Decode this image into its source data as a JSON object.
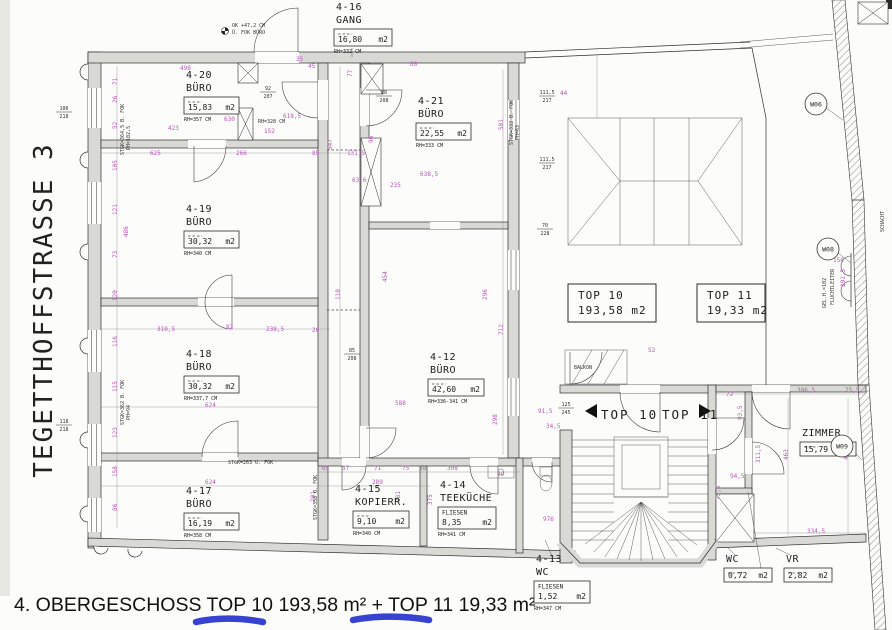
{
  "page": {
    "bottom_title": "4. OBERGESCHOSS TOP 10 193,58 m² + TOP 11 19,33 m²",
    "street_label": "TEGETTHOFFSTRASSE 3"
  },
  "colors": {
    "dimension_text": "#b75ab7",
    "marker_blue": "#2633cc",
    "wall_fill": "#d9d9d5"
  },
  "plan": {
    "stair_labels": {
      "left": "TOP 10",
      "right": "TOP 11"
    },
    "unit_boxes": [
      {
        "label": "TOP 10",
        "area": "193,58 m2",
        "x": 568,
        "y": 284,
        "w": 88,
        "h": 38
      },
      {
        "label": "TOP 11",
        "area": "19,33 m2",
        "x": 697,
        "y": 284,
        "w": 68,
        "h": 38
      }
    ],
    "wall_tags": [
      {
        "label": "W06",
        "x": 816,
        "y": 104
      },
      {
        "label": "W08",
        "x": 828,
        "y": 249
      },
      {
        "label": "W09",
        "x": 842,
        "y": 446
      }
    ],
    "rooms": [
      {
        "id": "4-20",
        "name": "BÜRO",
        "area": "15,83",
        "unit": "m2",
        "rh": "RH=357 CM",
        "x": 186,
        "y": 78,
        "bw": 55
      },
      {
        "id": "4-19",
        "name": "BÜRO",
        "area": "30,32",
        "unit": "m2",
        "rh": "RH=340 CM",
        "x": 186,
        "y": 212,
        "bw": 55
      },
      {
        "id": "4-18",
        "name": "BÜRO",
        "area": "30,32",
        "unit": "m2",
        "rh": "RH=337,7 CM",
        "x": 186,
        "y": 357,
        "bw": 55
      },
      {
        "id": "4-17",
        "name": "BÜRO",
        "area": "16,19",
        "unit": "m2",
        "rh": "RH=358 CM",
        "x": 186,
        "y": 494,
        "bw": 55
      },
      {
        "id": "4-16",
        "name": "GANG",
        "area": "16,80",
        "unit": "m2",
        "rh": "RH=332 CM",
        "x": 336,
        "y": 10,
        "bw": 58
      },
      {
        "id": "4-21",
        "name": "BÜRO",
        "area": "22,55",
        "unit": "m2",
        "rh": "RH=333 CM",
        "x": 418,
        "y": 104,
        "bw": 55
      },
      {
        "id": "4-12",
        "name": "BÜRO",
        "area": "42,60",
        "unit": "m2",
        "rh": "RH=336-341 CM",
        "x": 430,
        "y": 360,
        "bw": 56
      },
      {
        "id": "4-15",
        "name": "KOPIERR.",
        "area": "9,10",
        "unit": "m2",
        "rh": "RH=340 CM",
        "x": 355,
        "y": 492,
        "bw": 56
      },
      {
        "id": "4-14",
        "name": "TEEKÜCHE",
        "material": "FLIESEN",
        "area": "8,35",
        "unit": "m2",
        "rh": "RH=341 CM",
        "x": 440,
        "y": 488,
        "bw": 58
      },
      {
        "id": "4-13",
        "name": "WC",
        "material": "FLIESEN",
        "area": "1,52",
        "unit": "m2",
        "rh": "RH=347 CM",
        "x": 536,
        "y": 562,
        "bw": 56
      },
      {
        "name": "ZIMMER",
        "area": "15,79",
        "unit": "m2",
        "rh": "",
        "x": 802,
        "y": 436,
        "bw": 56
      },
      {
        "name": "WC",
        "area": "0,72",
        "unit": "m2",
        "rh": "",
        "x": 726,
        "y": 562,
        "bw": 48
      },
      {
        "name": "VR",
        "area": "2,82",
        "unit": "m2",
        "rh": "",
        "x": 786,
        "y": 562,
        "bw": 48
      }
    ],
    "door_sizes": [
      {
        "a": "92",
        "b": "207",
        "x": 268,
        "y": 90
      },
      {
        "a": "88",
        "b": "208",
        "x": 384,
        "y": 94
      },
      {
        "a": "85",
        "b": "208",
        "x": 352,
        "y": 352
      },
      {
        "a": "125",
        "b": "245",
        "x": 566,
        "y": 406
      },
      {
        "a": "111,5",
        "b": "217",
        "x": 547,
        "y": 94
      },
      {
        "a": "111,5",
        "b": "217",
        "x": 547,
        "y": 161
      },
      {
        "a": "70",
        "b": "228",
        "x": 545,
        "y": 227
      },
      {
        "a": "106",
        "b": "218",
        "x": 64,
        "y": 110
      },
      {
        "a": "118",
        "b": "218",
        "x": 64,
        "y": 423
      }
    ],
    "notes": [
      {
        "t": "OK +47,2 CM",
        "x": 232,
        "y": 27
      },
      {
        "t": "Ü. FOK BÜRO",
        "x": 232,
        "y": 34
      },
      {
        "t": "RH=328 CM",
        "x": 258,
        "y": 123
      },
      {
        "t": "STGK=364,5 B. FOK",
        "x": 124,
        "y": 155,
        "r": -90
      },
      {
        "t": "PH=102,5",
        "x": 130,
        "y": 150,
        "r": -90
      },
      {
        "t": "STGK=362 B. FOK",
        "x": 124,
        "y": 425,
        "r": -90
      },
      {
        "t": "PH=94",
        "x": 130,
        "y": 420,
        "r": -90
      },
      {
        "t": "STGK=332 B. FOK",
        "x": 513,
        "y": 145,
        "r": -90
      },
      {
        "t": "PH=63",
        "x": 519,
        "y": 140,
        "r": -90
      },
      {
        "t": "STGK=358 O. FOK",
        "x": 317,
        "y": 520,
        "r": -90
      },
      {
        "t": "STGK=263 U. FOK",
        "x": 228,
        "y": 464
      },
      {
        "t": "BALKON",
        "x": 574,
        "y": 369
      },
      {
        "t": "FLUCHTLEITER",
        "x": 834,
        "y": 305,
        "r": -90
      },
      {
        "t": "GEL.H.=102",
        "x": 826,
        "y": 308,
        "r": -90
      },
      {
        "t": "SCHACHT",
        "x": 884,
        "y": 232,
        "r": -90
      }
    ],
    "dims": [
      {
        "t": "498",
        "x": 180,
        "y": 70
      },
      {
        "t": "45",
        "x": 308,
        "y": 68
      },
      {
        "t": "35",
        "x": 296,
        "y": 61
      },
      {
        "t": "60",
        "x": 410,
        "y": 66
      },
      {
        "t": "423",
        "x": 168,
        "y": 130
      },
      {
        "t": "630",
        "x": 224,
        "y": 121
      },
      {
        "t": "618,5",
        "x": 283,
        "y": 118
      },
      {
        "t": "152",
        "x": 264,
        "y": 133
      },
      {
        "t": "625",
        "x": 150,
        "y": 155
      },
      {
        "t": "266",
        "x": 236,
        "y": 155
      },
      {
        "t": "85",
        "x": 312,
        "y": 155
      },
      {
        "t": "131,5",
        "x": 347,
        "y": 155
      },
      {
        "t": "310,5",
        "x": 157,
        "y": 331
      },
      {
        "t": "82",
        "x": 226,
        "y": 329
      },
      {
        "t": "238,5",
        "x": 266,
        "y": 331
      },
      {
        "t": "26",
        "x": 312,
        "y": 332
      },
      {
        "t": "624",
        "x": 205,
        "y": 407
      },
      {
        "t": "624",
        "x": 205,
        "y": 484
      },
      {
        "t": "71",
        "x": 117,
        "y": 85,
        "r": -90
      },
      {
        "t": "26",
        "x": 117,
        "y": 103,
        "r": -90
      },
      {
        "t": "52",
        "x": 117,
        "y": 129,
        "r": -90
      },
      {
        "t": "105",
        "x": 117,
        "y": 171,
        "r": -90
      },
      {
        "t": "121",
        "x": 117,
        "y": 215,
        "r": -90
      },
      {
        "t": "73",
        "x": 117,
        "y": 258,
        "r": -90
      },
      {
        "t": "486",
        "x": 128,
        "y": 237,
        "r": -90
      },
      {
        "t": "120",
        "x": 117,
        "y": 301,
        "r": -90
      },
      {
        "t": "116",
        "x": 117,
        "y": 347,
        "r": -90
      },
      {
        "t": "115",
        "x": 117,
        "y": 392,
        "r": -90
      },
      {
        "t": "123",
        "x": 117,
        "y": 438,
        "r": -90
      },
      {
        "t": "158",
        "x": 117,
        "y": 477,
        "r": -90
      },
      {
        "t": "86",
        "x": 117,
        "y": 511,
        "r": -90
      },
      {
        "t": "547",
        "x": 332,
        "y": 150,
        "r": -90
      },
      {
        "t": "110",
        "x": 340,
        "y": 300,
        "r": -90
      },
      {
        "t": "63,6",
        "x": 352,
        "y": 182
      },
      {
        "t": "454",
        "x": 387,
        "y": 282,
        "r": -90
      },
      {
        "t": "96",
        "x": 373,
        "y": 143,
        "r": -90
      },
      {
        "t": "77",
        "x": 352,
        "y": 77,
        "r": -90
      },
      {
        "t": "588",
        "x": 395,
        "y": 405
      },
      {
        "t": "638,5",
        "x": 420,
        "y": 176
      },
      {
        "t": "235",
        "x": 390,
        "y": 187
      },
      {
        "t": "581",
        "x": 503,
        "y": 130,
        "r": -90
      },
      {
        "t": "712",
        "x": 503,
        "y": 335,
        "r": -90
      },
      {
        "t": "298",
        "x": 497,
        "y": 425,
        "r": -90
      },
      {
        "t": "296",
        "x": 487,
        "y": 300,
        "r": -90
      },
      {
        "t": "65",
        "x": 322,
        "y": 470
      },
      {
        "t": "57",
        "x": 342,
        "y": 470
      },
      {
        "t": "71",
        "x": 374,
        "y": 470
      },
      {
        "t": "75",
        "x": 402,
        "y": 470
      },
      {
        "t": "38",
        "x": 419,
        "y": 470
      },
      {
        "t": "289",
        "x": 372,
        "y": 484
      },
      {
        "t": "201",
        "x": 315,
        "y": 502,
        "r": -90
      },
      {
        "t": "281",
        "x": 400,
        "y": 502,
        "r": -90
      },
      {
        "t": "375",
        "x": 432,
        "y": 505,
        "r": -90
      },
      {
        "t": "308",
        "x": 447,
        "y": 470
      },
      {
        "t": "29",
        "x": 497,
        "y": 476
      },
      {
        "t": "52",
        "x": 648,
        "y": 352
      },
      {
        "t": "150",
        "x": 833,
        "y": 262
      },
      {
        "t": "291,5",
        "x": 845,
        "y": 287,
        "r": -90
      },
      {
        "t": "72",
        "x": 726,
        "y": 396
      },
      {
        "t": "306,5",
        "x": 797,
        "y": 392
      },
      {
        "t": "75,5",
        "x": 845,
        "y": 392
      },
      {
        "t": "463",
        "x": 788,
        "y": 460,
        "r": -90
      },
      {
        "t": "450",
        "x": 848,
        "y": 460,
        "r": -90
      },
      {
        "t": "311,5",
        "x": 760,
        "y": 463,
        "r": -90
      },
      {
        "t": "334,5",
        "x": 807,
        "y": 533
      },
      {
        "t": "93,5",
        "x": 742,
        "y": 420,
        "r": -90
      },
      {
        "t": "73,5",
        "x": 720,
        "y": 500,
        "r": -90
      },
      {
        "t": "94,5",
        "x": 730,
        "y": 478
      },
      {
        "t": "91,5",
        "x": 538,
        "y": 413
      },
      {
        "t": "34,5",
        "x": 546,
        "y": 428
      },
      {
        "t": "976",
        "x": 543,
        "y": 521
      },
      {
        "t": "44",
        "x": 560,
        "y": 95
      }
    ]
  }
}
